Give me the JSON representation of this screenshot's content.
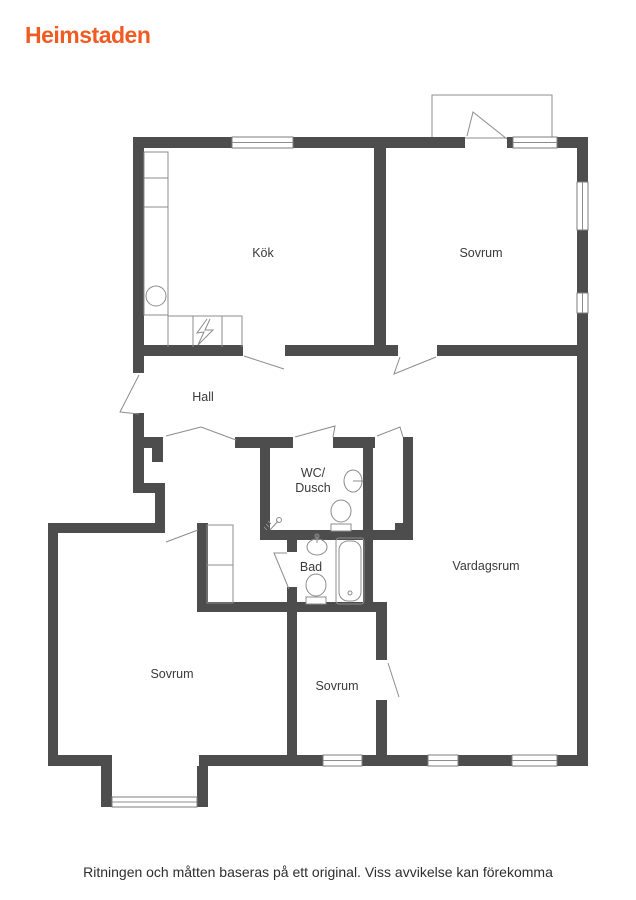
{
  "header": {
    "logo": "Heimstaden"
  },
  "floorplan": {
    "rooms": {
      "kitchen": "Kök",
      "bedroom_top_right": "Sovrum",
      "hall": "Hall",
      "wc_line1": "WC/",
      "wc_line2": "Dusch",
      "bathroom": "Bad",
      "living_room": "Vardagsrum",
      "bedroom_bottom_left": "Sovrum",
      "bedroom_bottom_middle": "Sovrum"
    },
    "fixtures": [
      "kitchen-counter",
      "kitchen-sink",
      "stove",
      "wardrobe",
      "balcony",
      "wc-sink",
      "wc-toilet",
      "shower",
      "bath-sink",
      "bath-toilet",
      "bathtub",
      "bay-window"
    ]
  },
  "footer": {
    "disclaimer": "Ritningen och måtten baseras på ett original. Viss avvikelse kan förekomma"
  },
  "colors": {
    "brand_orange": "#F15A22",
    "wall": "#4D4D4D",
    "fixture_line": "#8C8C8C",
    "label_text": "#3A3A3A"
  }
}
